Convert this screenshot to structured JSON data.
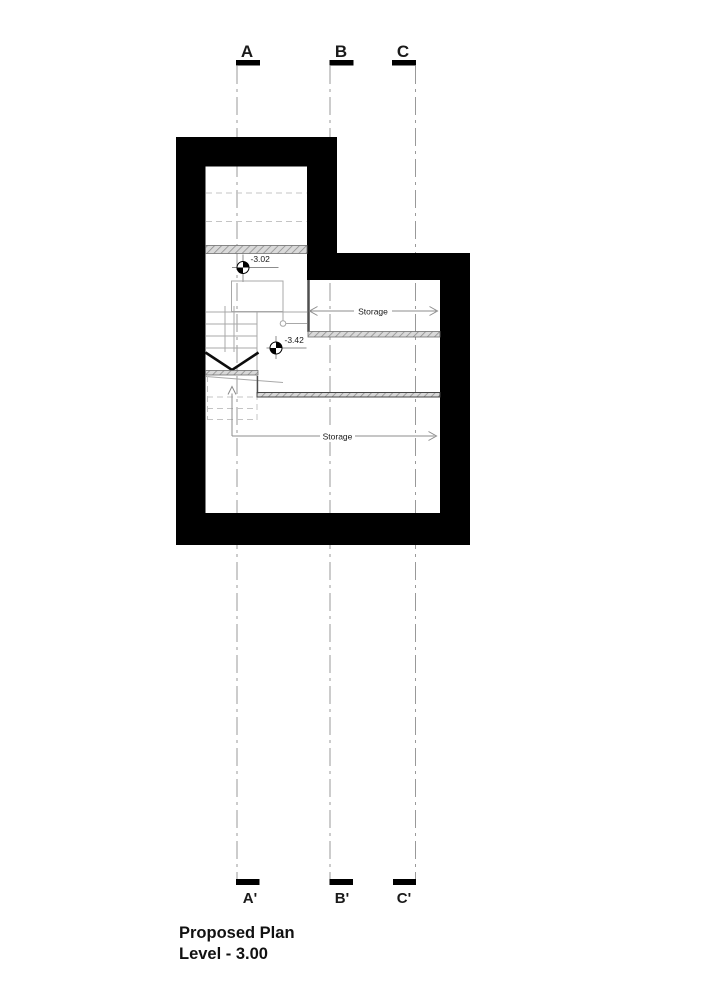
{
  "grid": {
    "top": [
      {
        "label": "A"
      },
      {
        "label": "B"
      },
      {
        "label": "C"
      }
    ],
    "bottom": [
      {
        "label": "A'"
      },
      {
        "label": "B'"
      },
      {
        "label": "C'"
      }
    ]
  },
  "plan": {
    "level_markers": [
      {
        "value": "-3.02"
      },
      {
        "value": "-3.42"
      }
    ],
    "rooms": [
      {
        "label": "Storage"
      },
      {
        "label": "Storage"
      }
    ]
  },
  "title": {
    "line1": "Proposed Plan",
    "line2": "Level - 3.00"
  },
  "colors": {
    "wall": "#000000",
    "grid_line": "#999999",
    "stair_line": "#a8a8a8",
    "dashed_line": "#c4c4c4",
    "dim_line": "#8c8c8c",
    "annotation": "#1a1a1a"
  }
}
